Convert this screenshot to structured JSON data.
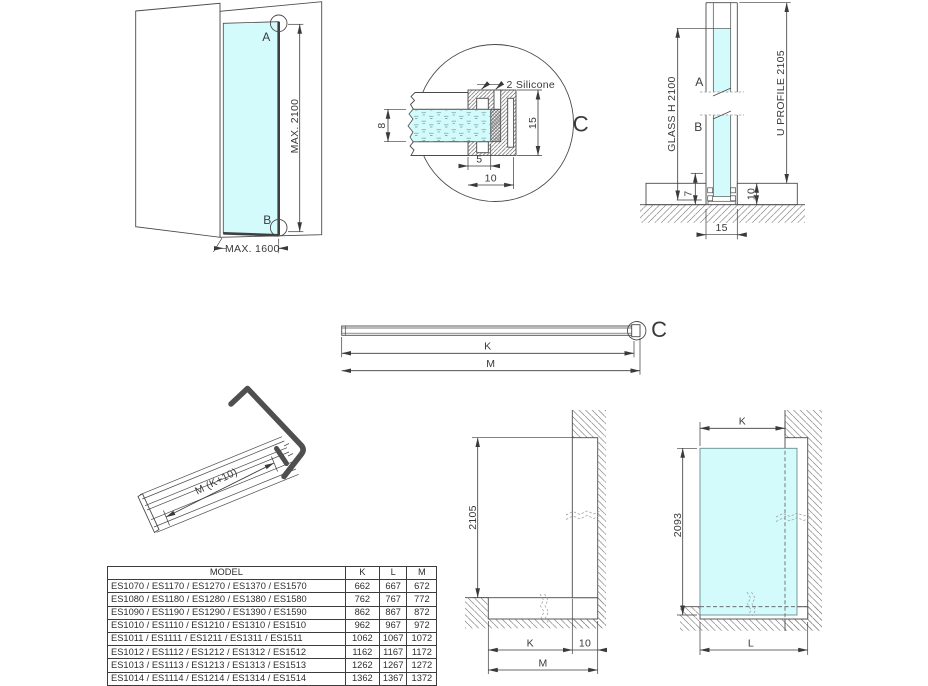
{
  "colors": {
    "glass": "#d4fbfc",
    "line": "#4a4a4a",
    "text": "#3a3a3a",
    "profile_dark": "#4f4f4f"
  },
  "corner_view": {
    "label_a": "A",
    "label_b": "B",
    "dim_height": "MAX. 2100",
    "dim_width": "MAX. 1600"
  },
  "detail_view": {
    "letter": "C",
    "silicone": "2 Silicone",
    "dim_glass_thickness": "8",
    "dim_profile_height": "15",
    "dim_inset": "5",
    "dim_depth": "10"
  },
  "floor_section": {
    "label_a": "A",
    "label_b": "B",
    "glass_label": "GLASS H 2100",
    "profile_label": "U PROFILE 2105",
    "dim_7": "7",
    "dim_10": "10",
    "dim_15": "15"
  },
  "bar_view": {
    "letter": "C",
    "dim_k": "K",
    "dim_m": "M"
  },
  "iso_view": {
    "dim_length": "M (K+10)"
  },
  "recess_section": {
    "dim_height": "2105",
    "dim_k": "K",
    "dim_10": "10",
    "dim_m": "M"
  },
  "panel_view": {
    "dim_k": "K",
    "dim_height": "2093",
    "dim_l": "L"
  },
  "spec_table": {
    "headers": [
      "MODEL",
      "K",
      "L",
      "M"
    ],
    "rows": [
      {
        "model": "ES1070 / ES1170 / ES1270 / ES1370 / ES1570",
        "k": "662",
        "l": "667",
        "m": "672"
      },
      {
        "model": "ES1080 / ES1180 / ES1280 / ES1380 / ES1580",
        "k": "762",
        "l": "767",
        "m": "772"
      },
      {
        "model": "ES1090 / ES1190 / ES1290 / ES1390 / ES1590",
        "k": "862",
        "l": "867",
        "m": "872"
      },
      {
        "model": "ES1010 / ES1110 / ES1210 / ES1310 / ES1510",
        "k": "962",
        "l": "967",
        "m": "972"
      },
      {
        "model": "ES1011 / ES1111 / ES1211 / ES1311 / ES1511",
        "k": "1062",
        "l": "1067",
        "m": "1072"
      },
      {
        "model": "ES1012 / ES1112 / ES1212 / ES1312 / ES1512",
        "k": "1162",
        "l": "1167",
        "m": "1172"
      },
      {
        "model": "ES1013 / ES1113 / ES1213 / ES1313 / ES1513",
        "k": "1262",
        "l": "1267",
        "m": "1272"
      },
      {
        "model": "ES1014 / ES1114 / ES1214 / ES1314 / ES1514",
        "k": "1362",
        "l": "1367",
        "m": "1372"
      }
    ]
  }
}
